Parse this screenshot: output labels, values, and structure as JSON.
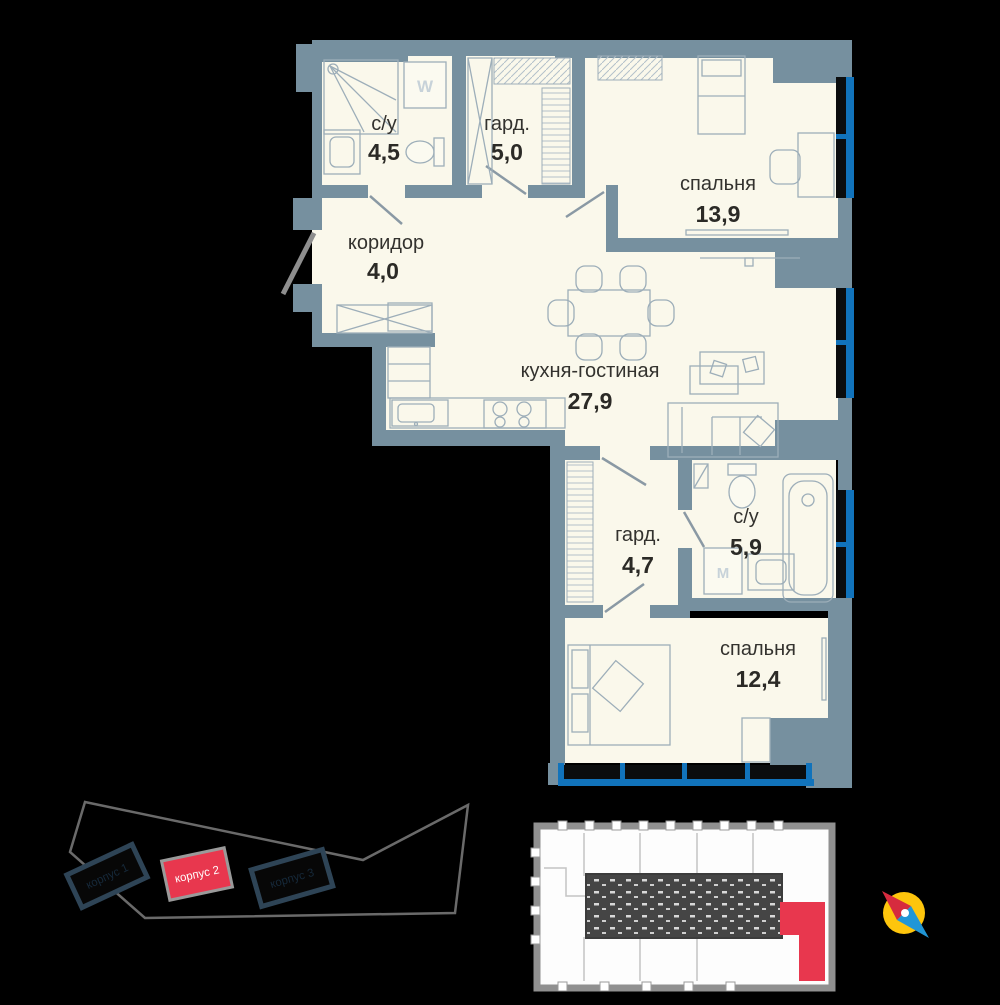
{
  "floor_plan": {
    "rooms": [
      {
        "id": "bathroom-1",
        "name": "с/у",
        "area": "4,5"
      },
      {
        "id": "wardrobe-1",
        "name": "гард.",
        "area": "5,0"
      },
      {
        "id": "bedroom-1",
        "name": "спальня",
        "area": "13,9"
      },
      {
        "id": "corridor",
        "name": "коридор",
        "area": "4,0"
      },
      {
        "id": "kitchen-living",
        "name": "кухня-гостиная",
        "area": "27,9"
      },
      {
        "id": "wardrobe-2",
        "name": "гард.",
        "area": "4,7"
      },
      {
        "id": "bathroom-2",
        "name": "с/у",
        "area": "5,9"
      },
      {
        "id": "bedroom-2",
        "name": "спальня",
        "area": "12,4"
      }
    ],
    "appliances": {
      "washer_top_label": "W",
      "washer_bottom_label": "М"
    }
  },
  "site_plan": {
    "buildings": [
      {
        "label": "корпус 1",
        "highlighted": false
      },
      {
        "label": "корпус 2",
        "highlighted": true
      },
      {
        "label": "корпус 3",
        "highlighted": false
      }
    ]
  },
  "key_plan": {
    "highlighted_unit": "selected-apartment"
  },
  "colors": {
    "wall": "#76909f",
    "floor": "#faf8eb",
    "window": "#1173bb",
    "accent_red": "#e8374e",
    "compass_yellow": "#fec50c",
    "background": "#000000"
  }
}
